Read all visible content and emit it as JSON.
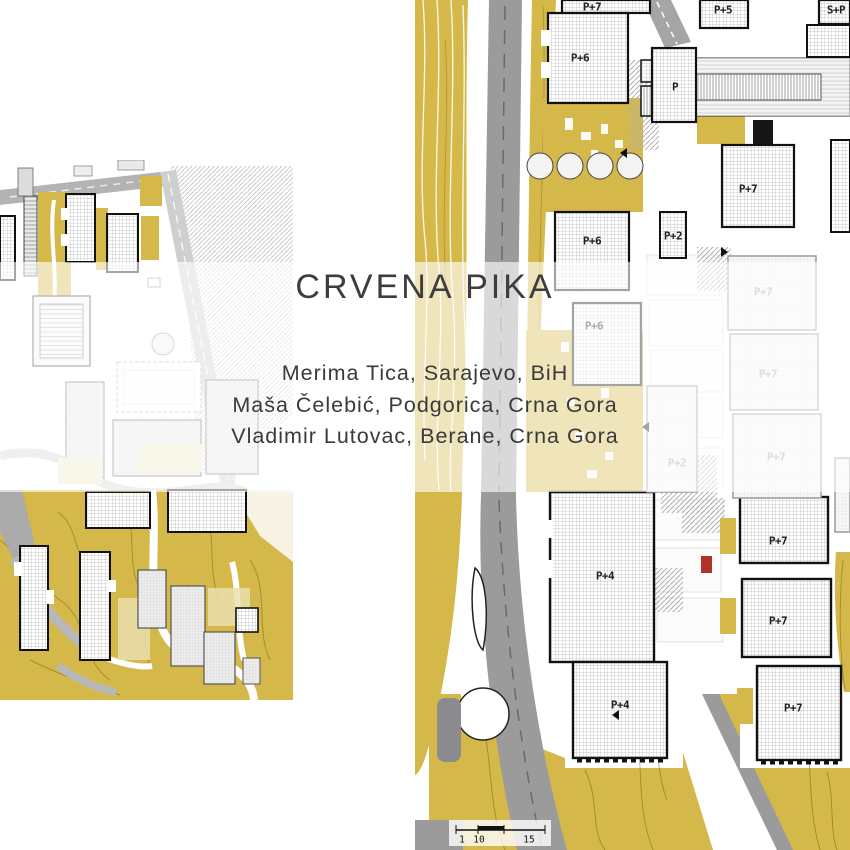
{
  "header": {
    "title": "CRVENA PIKA",
    "authors": [
      "Merima Tica, Sarajevo, BiH",
      "Maša Čelebić, Podgorica, Crna Gora",
      "Vladimir Lutovac, Berane, Crna Gora"
    ]
  },
  "right_map": {
    "building_labels": [
      {
        "text": "P+7",
        "x": 177,
        "y": 7,
        "variant": "dark"
      },
      {
        "text": "P+6",
        "x": 165,
        "y": 58,
        "variant": "dark"
      },
      {
        "text": "P",
        "x": 260,
        "y": 87,
        "variant": "dark"
      },
      {
        "text": "P+5",
        "x": 308,
        "y": 10,
        "variant": "dark"
      },
      {
        "text": "S+P",
        "x": 421,
        "y": 10,
        "variant": "dark"
      },
      {
        "text": "P+7",
        "x": 333,
        "y": 189,
        "variant": "dark"
      },
      {
        "text": "P+2",
        "x": 258,
        "y": 236,
        "variant": "dark"
      },
      {
        "text": "P+6",
        "x": 177,
        "y": 241,
        "variant": "dark"
      },
      {
        "text": "P+6",
        "x": 179,
        "y": 326,
        "variant": "dark"
      },
      {
        "text": "P+7",
        "x": 348,
        "y": 292,
        "variant": "faded"
      },
      {
        "text": "P+7",
        "x": 353,
        "y": 374,
        "variant": "faded"
      },
      {
        "text": "P+7",
        "x": 361,
        "y": 457,
        "variant": "faded"
      },
      {
        "text": "P+2",
        "x": 262,
        "y": 463,
        "variant": "faded"
      },
      {
        "text": "P+4",
        "x": 190,
        "y": 576,
        "variant": "dark"
      },
      {
        "text": "P+7",
        "x": 363,
        "y": 541,
        "variant": "dark"
      },
      {
        "text": "P+7",
        "x": 363,
        "y": 621,
        "variant": "dark"
      },
      {
        "text": "P+4",
        "x": 205,
        "y": 705,
        "variant": "dark"
      },
      {
        "text": "P+7",
        "x": 378,
        "y": 708,
        "variant": "dark"
      }
    ],
    "scale_bar": {
      "tick_labels": [
        {
          "text": "1",
          "x": 47,
          "y": 840,
          "variant": "scale"
        },
        {
          "text": "10",
          "x": 64,
          "y": 840,
          "variant": "scale"
        },
        {
          "text": "15",
          "x": 114,
          "y": 840,
          "variant": "scale"
        }
      ]
    }
  },
  "colors": {
    "terrain_yellow": "#d4b84a",
    "road_gray": "#9b9b9b",
    "red_dot": "#b23229",
    "title_text": "#3d3d3d"
  }
}
